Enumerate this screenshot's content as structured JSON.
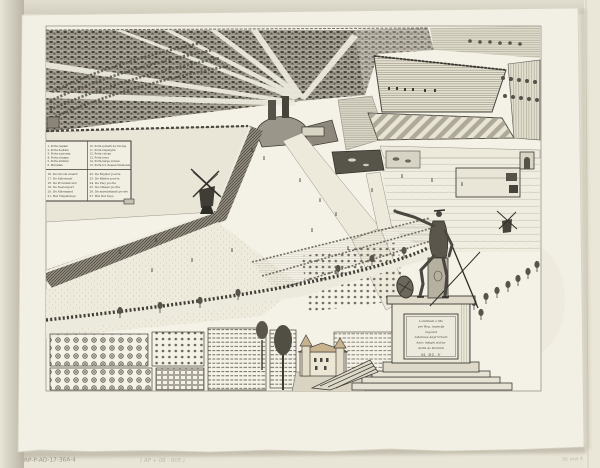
{
  "palette": {
    "background": "#e8e4d6",
    "paper": "#f2efe4",
    "plate": "#f4f1e7",
    "ink_dark": "#3b3933",
    "ink_mid": "#6e6a5d",
    "warm_roof": "#c9b28e",
    "shadow": "#b3ae9f",
    "pond": "#57544a"
  },
  "legend": {
    "upper_left": [
      "1. Porta regiam",
      "2. Porta hedram",
      "3. Porta equoram",
      "4. Porta slusana",
      "5. Porta militum",
      "6. Murallen"
    ],
    "upper_right": [
      "10. Porta lysbeth de l'Gorge",
      "11. Porta bispelgrin",
      "12. Porta vulcan",
      "13. Porta heyn",
      "14. Porta harge vicinal",
      "15. Porta for clessen timmeren"
    ],
    "lower_left": [
      "16. De Groote muerd",
      "17. De Abberneyf",
      "18. De Providencerd",
      "19. De Neeverport",
      "20. De Abbemarst",
      "21. Het Vlayshuleys"
    ],
    "lower_right": [
      "22. De Reysler poorte",
      "23. De Ridder poorte",
      "24. De Vley poorte",
      "25. De Clissen poorte",
      "26. De maeckelandt poorte",
      "27. Het Dul huys"
    ]
  },
  "monument": {
    "inscription_lines": [
      "Londinum a Ma",
      "per Reg. imperijs",
      "regedat",
      "Iohannes Angl Vrbem",
      "hanc insigni statua",
      "dedit Ao Dominii",
      "M. DC. V"
    ]
  },
  "annotations": {
    "inventory_number": "RP-P-AO-17-36A-4",
    "center_pencil_note": "( AP + 08 - 005 )",
    "corner_pencil_note": "5K mw 4"
  }
}
